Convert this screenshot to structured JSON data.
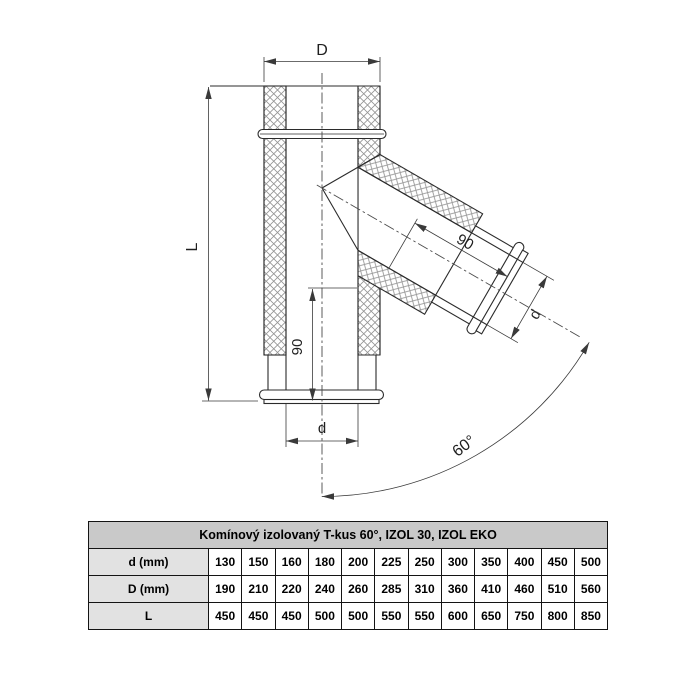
{
  "diagram": {
    "labels": {
      "outer_diameter": "D",
      "length": "L",
      "inner_diameter_bottom": "d",
      "inner_diameter_branch": "d",
      "offset_main": "90",
      "offset_branch": "90",
      "branch_angle": "60°"
    },
    "colors": {
      "line": "#2b2b2b",
      "hatch": "#949494",
      "dimension_line": "#3a3a3a"
    }
  },
  "table": {
    "title": "Komínový izolovaný T-kus 60°, IZOL 30, IZOL EKO",
    "colors": {
      "title_bg": "#c9c9c9",
      "label_bg": "#e2e2e2",
      "border": "#141414"
    },
    "rows": [
      {
        "label": "d (mm)",
        "values": [
          "130",
          "150",
          "160",
          "180",
          "200",
          "225",
          "250",
          "300",
          "350",
          "400",
          "450",
          "500"
        ]
      },
      {
        "label": "D (mm)",
        "values": [
          "190",
          "210",
          "220",
          "240",
          "260",
          "285",
          "310",
          "360",
          "410",
          "460",
          "510",
          "560"
        ]
      },
      {
        "label": "L",
        "values": [
          "450",
          "450",
          "450",
          "500",
          "500",
          "550",
          "550",
          "600",
          "650",
          "750",
          "800",
          "850"
        ]
      }
    ]
  }
}
